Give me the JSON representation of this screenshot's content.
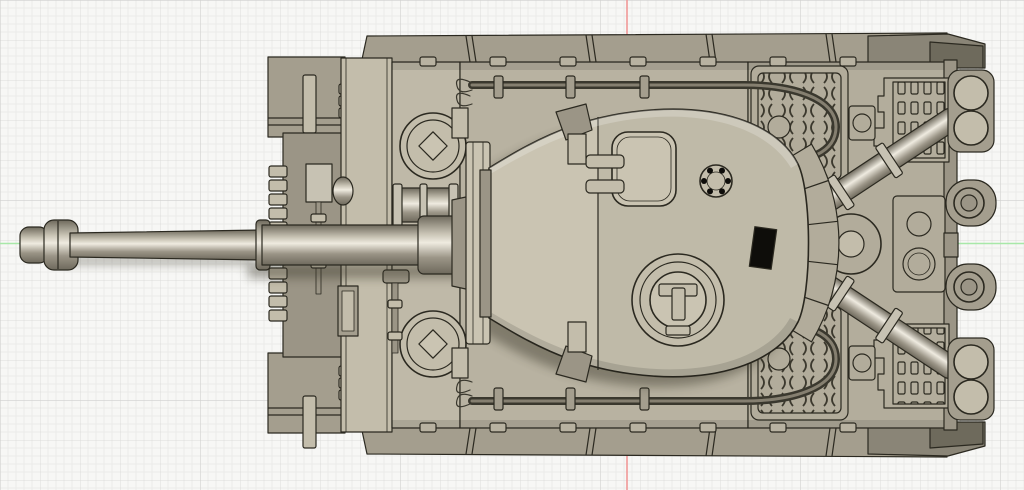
{
  "app": {
    "kind": "3d-cad-viewport",
    "view_orientation": "top",
    "background": "grid paper"
  },
  "scene": {
    "model_name": "Tiger I heavy tank 3D model, top-down view",
    "components": [
      "gun barrel",
      "muzzle brake",
      "barrel sleeve",
      "gun mantlet",
      "driver hatch",
      "radio operator hatch",
      "headlight",
      "ventilator",
      "tow cables",
      "cable clamps",
      "turret",
      "loader hatch",
      "pistol port",
      "commander cupola",
      "cupola hatch handle",
      "turret stowage bin",
      "engine deck grilles",
      "air intake vents",
      "engine access plate",
      "fuel filler cap",
      "exhaust pipes",
      "exhaust mufflers",
      "rear shackle mounts",
      "track guards",
      "front fenders",
      "spare track links",
      "pioneer tools"
    ]
  },
  "axes": {
    "red_vertical_line_x": 627,
    "green_horizontal_line_y": 243.5
  },
  "grid": {
    "minor_step_px": 8,
    "major_step_px": 40,
    "super_step_px": 200
  },
  "colors": {
    "bg": "#f7f7f5",
    "grid_minor": "#ebebe9",
    "grid_major": "#dcdcda",
    "grid_super": "#d0d0ce",
    "axis_red": "#f09898",
    "axis_green": "#a8e8a8",
    "outline": "#2b2920",
    "deck": "#b8b2a1",
    "deck2": "#b3ad9c",
    "front_deck": "#bfb9a8",
    "plate": "#c3bdab",
    "fender": "#a49e8e",
    "fender_dark": "#8a8577",
    "corner_dark": "#6e6a5c",
    "recess": "#9b9586",
    "turret": "#cac4b2",
    "panel": "#b2ac9b",
    "slot": "#3c392e",
    "cable": "#3a382e",
    "cable_hi": "#857f70",
    "black": "#0e0d0a",
    "metal_dark": "#6e695c",
    "metal_mid": "#9b9587",
    "metal_base": "#c7c2b3",
    "metal_light": "#efebe0"
  }
}
